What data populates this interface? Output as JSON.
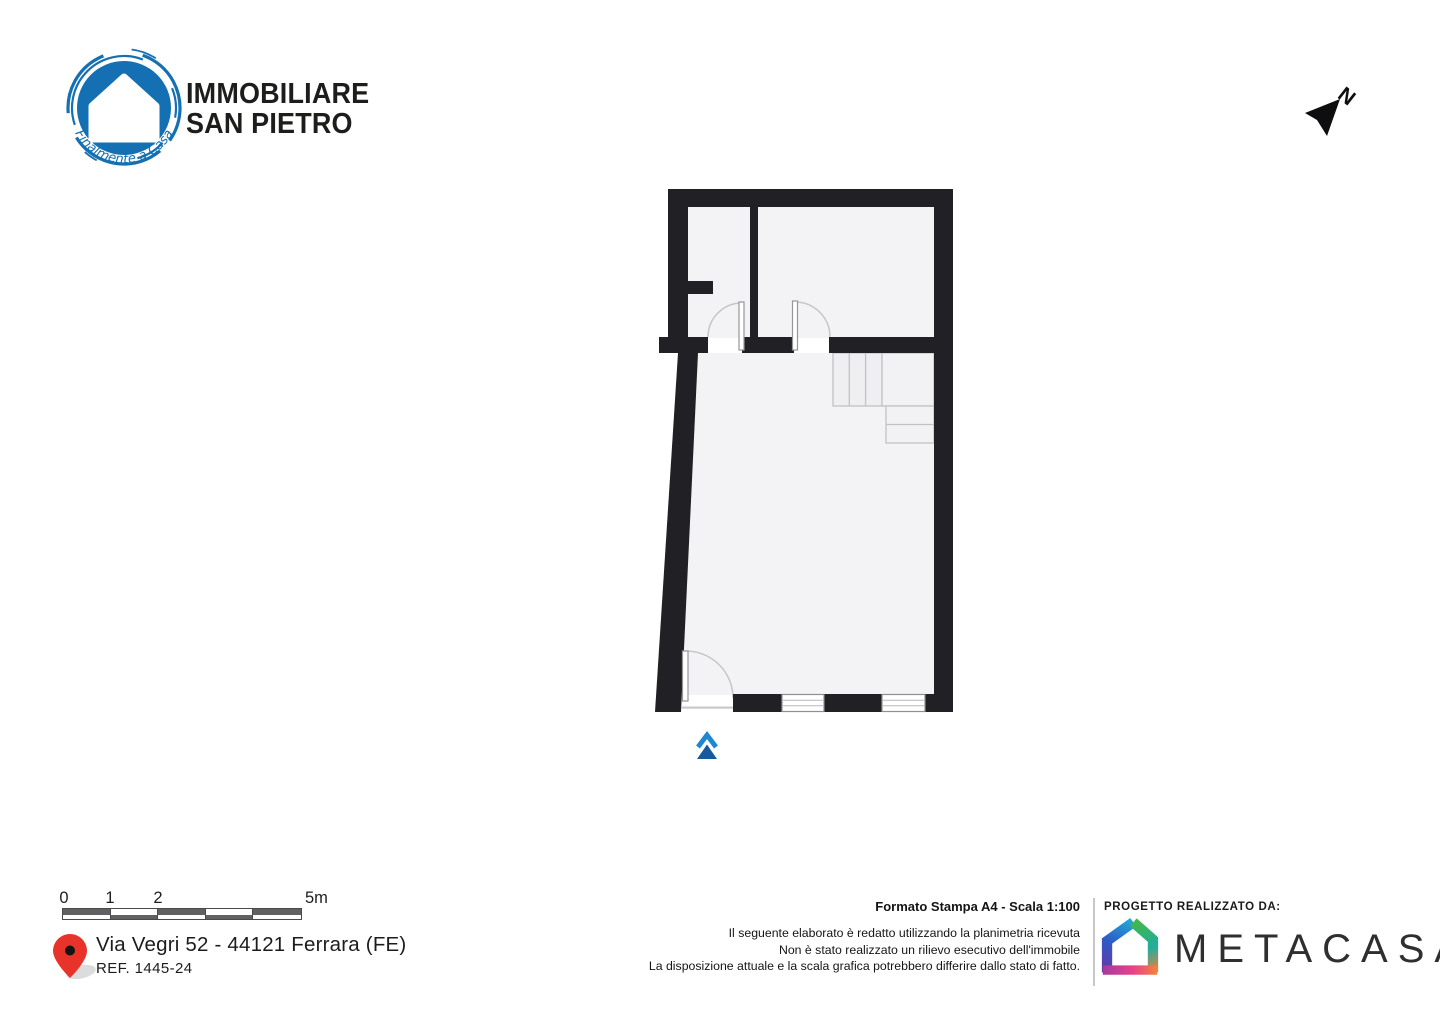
{
  "brand": {
    "name_line1": "IMMOBILIARE",
    "name_line2": "SAN PIETRO",
    "tagline": "Finalmente a Casa",
    "blue": "#1470b2",
    "text_color": "#1d1d1b"
  },
  "north_indicator": {
    "label": "N"
  },
  "floor_plan": {
    "wall_color": "#212125",
    "floor_color": "#f3f3f5",
    "door_line_color": "#c6c6ca",
    "entrance_arrow": {
      "light_blue": "#1d87d2",
      "dark_blue": "#15599f"
    }
  },
  "scale_bar": {
    "labels": [
      "0",
      "1",
      "2",
      "5m"
    ],
    "segments": 5,
    "dark": "#616163",
    "light": "#ffffff"
  },
  "address": {
    "line1": "Via Vegri 52 - 44121 Ferrara (FE)",
    "ref": "REF. 1445-24",
    "pin_color": "#e8332a"
  },
  "print_info": {
    "format_line": "Formato Stampa A4 - Scala 1:100",
    "disclaimer_lines": [
      "Il seguente elaborato è redatto utilizzando la planimetria ricevuta",
      "Non è stato realizzato un rilievo esecutivo dell'immobile",
      "La disposizione attuale e la scala grafica potrebbero differire dallo stato di fatto."
    ]
  },
  "credits": {
    "heading": "PROGETTO REALIZZATO DA:",
    "company": "METACASA",
    "logo_colors": [
      "#6a35a8",
      "#2f5ac5",
      "#1fa9d8",
      "#45b649",
      "#1fae9e",
      "#ef7f3c",
      "#a83a9e",
      "#e84189",
      "#f2813f"
    ]
  }
}
